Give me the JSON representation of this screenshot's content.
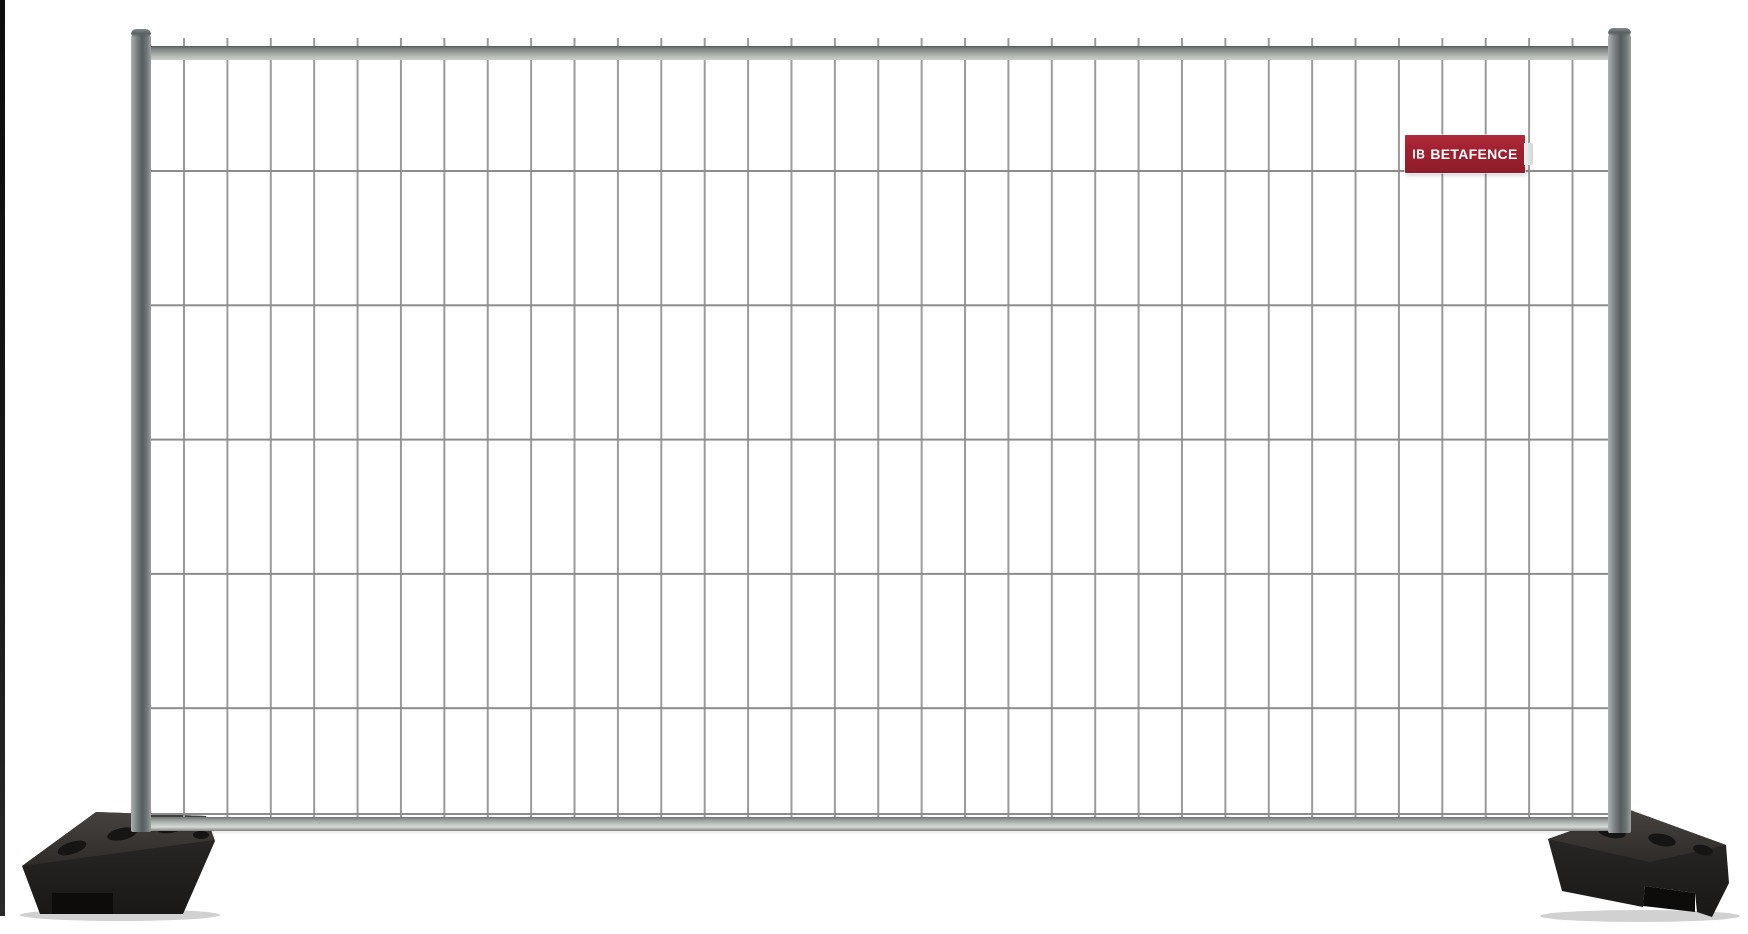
{
  "scene": {
    "description": "Product photo of a galvanized temporary mobile fencing panel (wire mesh infill, round steel frame) standing on two black recycled-rubber feet, white studio background",
    "background": "#ffffff"
  },
  "brand_plate": {
    "logo_glyph": "IB",
    "text": "BETAFENCE"
  },
  "colors": {
    "background": "#ffffff",
    "brand-red": "#9f2130",
    "plate-text": "#ffffff",
    "wire": "#9a9a9a",
    "wire-h": "#8c8c8c",
    "metal-dark": "#575d5f",
    "metal-light": "#cbcfcc",
    "foot-top": "#3d3936",
    "foot-front": "#232120",
    "edge-strip": "#1a1a1a"
  },
  "mesh": {
    "vertical_wires": 33,
    "horizontal_wires": 6,
    "vertical_spacing_px": 43.4,
    "horizontal_spacing_px": 134.3
  }
}
